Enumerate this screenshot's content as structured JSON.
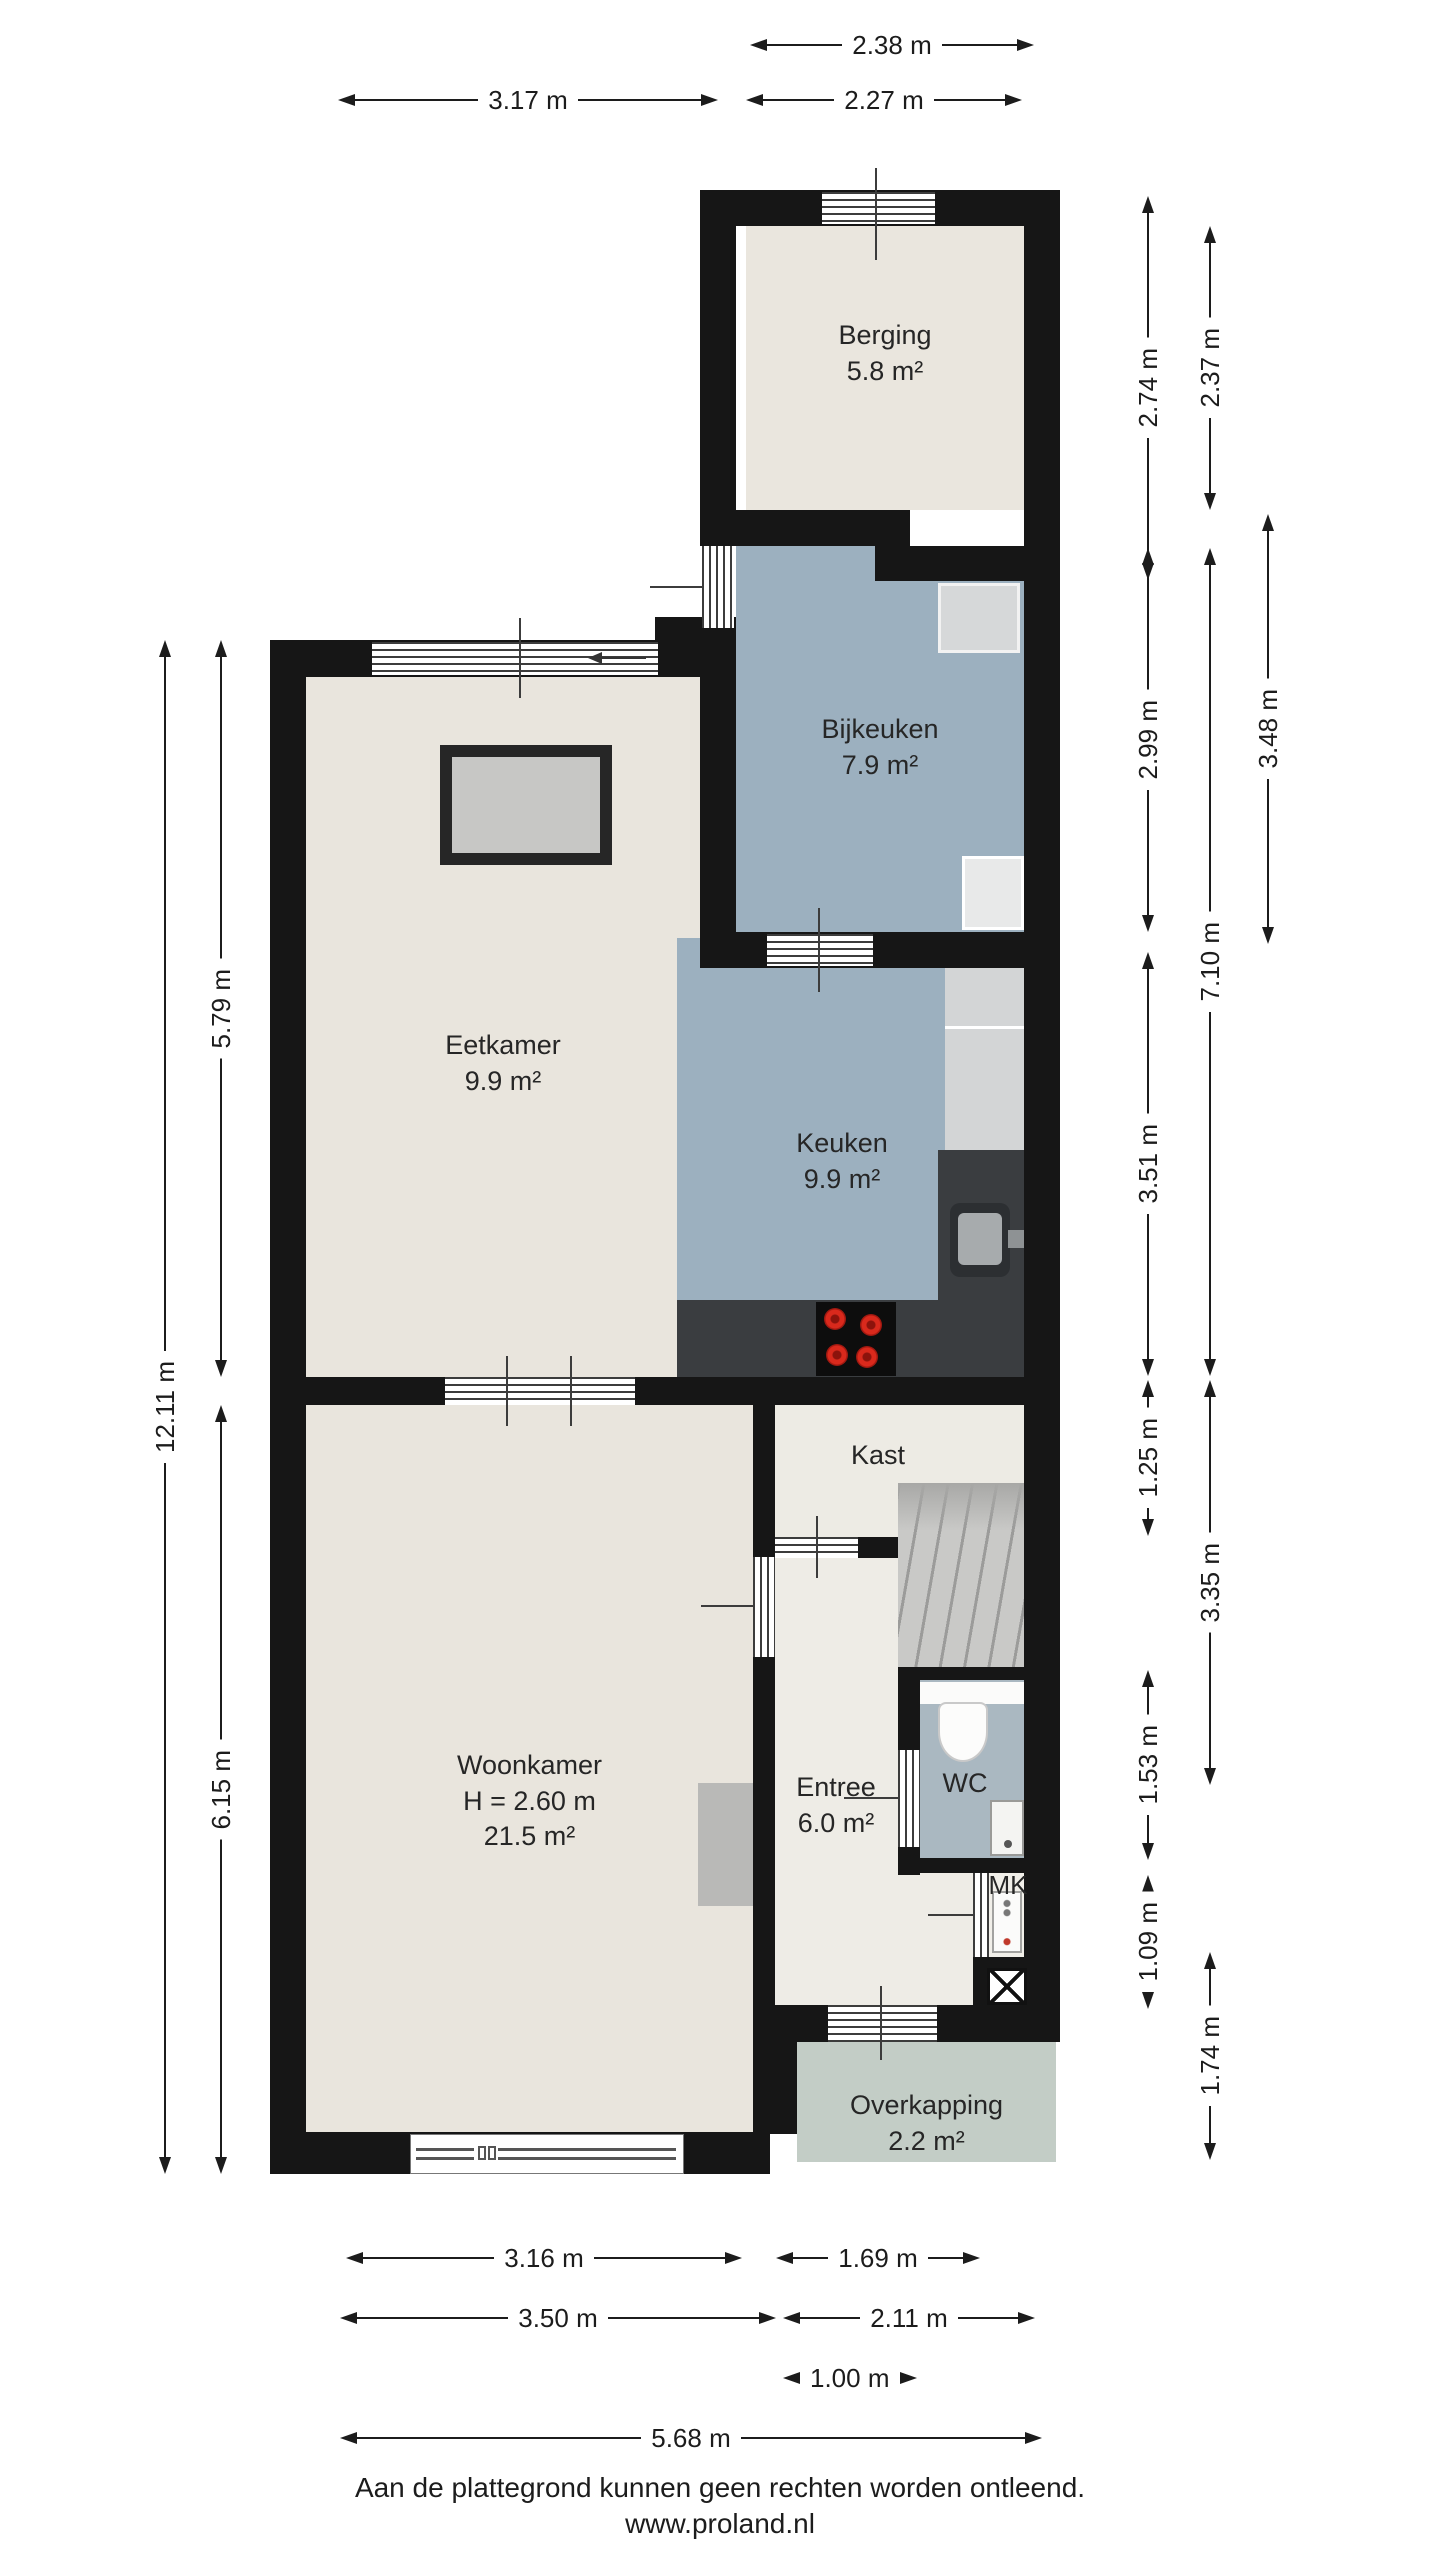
{
  "document": {
    "type": "floor-plan",
    "disclaimer": "Aan de plattegrond kunnen geen rechten worden ontleend.",
    "website": "www.proland.nl"
  },
  "colors": {
    "wall": "#161616",
    "floor_light": "#e9e5dd",
    "floor_blue": "#9cb0bf",
    "floor_wc": "#aab8c1",
    "floor_overkapping": "#c3cdc6",
    "counter_dark": "#3a3d40",
    "appliance_gray": "#d3d5d6",
    "stairs_gray": "#c9c9c7",
    "burner_red": "#d9291c"
  },
  "rooms": {
    "berging": {
      "name": "Berging",
      "area": "5.8 m²"
    },
    "bijkeuken": {
      "name": "Bijkeuken",
      "area": "7.9 m²"
    },
    "eetkamer": {
      "name": "Eetkamer",
      "area": "9.9 m²"
    },
    "keuken": {
      "name": "Keuken",
      "area": "9.9 m²"
    },
    "kast": {
      "name": "Kast"
    },
    "woonkamer": {
      "name": "Woonkamer",
      "height": "H = 2.60 m",
      "area": "21.5 m²"
    },
    "entree": {
      "name": "Entree",
      "area": "6.0 m²"
    },
    "wc": {
      "name": "WC"
    },
    "mk": {
      "name": "MK"
    },
    "overkapping": {
      "name": "Overkapping",
      "area": "2.2 m²"
    }
  },
  "dimensions": {
    "top": [
      "2.38 m",
      "3.17 m",
      "2.27 m"
    ],
    "left": [
      "12.11 m",
      "5.79 m",
      "6.15 m"
    ],
    "right": [
      "2.74 m",
      "2.37 m",
      "2.99 m",
      "3.48 m",
      "7.10 m",
      "3.51 m",
      "1.25 m",
      "3.35 m",
      "1.53 m",
      "1.09 m",
      "1.74 m"
    ],
    "bottom": [
      "3.16 m",
      "1.69 m",
      "3.50 m",
      "2.11 m",
      "1.00 m",
      "5.68 m"
    ]
  }
}
